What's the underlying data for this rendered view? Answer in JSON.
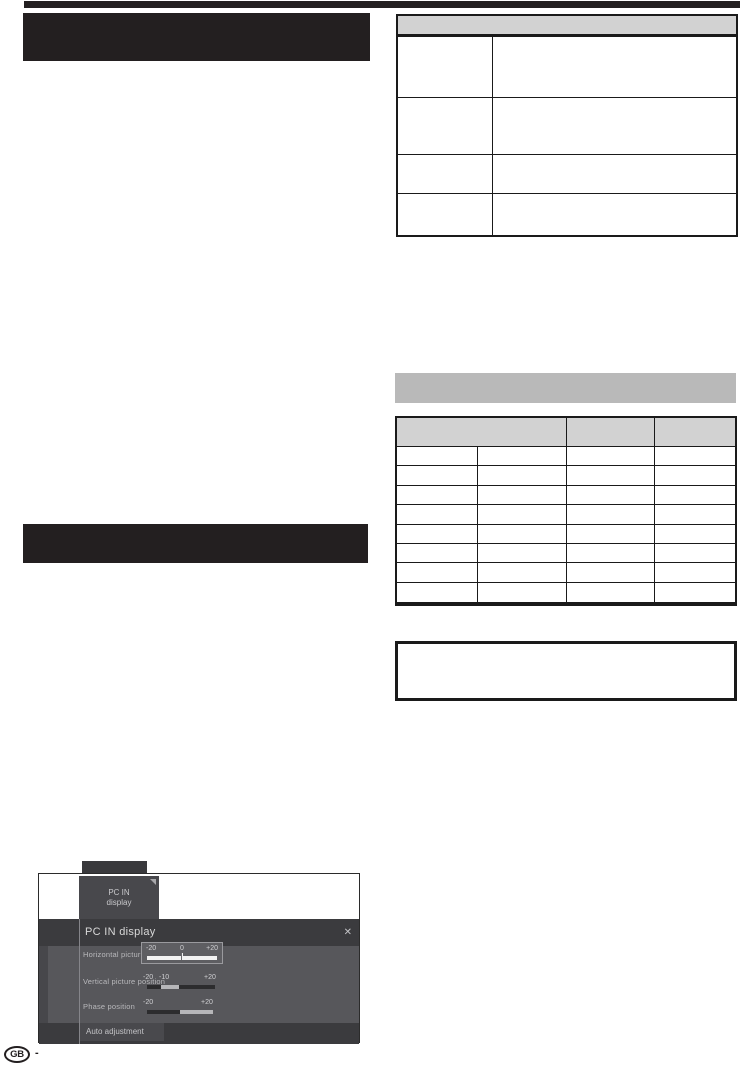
{
  "colors": {
    "print_black": "#231f20",
    "table_header_gray": "#d2d2d2",
    "section_bar_gray": "#b9b9b9",
    "osd_panel_gray": "#57575b",
    "osd_dark_gray": "#3b3b3e"
  },
  "osd_screenshot": {
    "tab": {
      "line1": "PC IN",
      "line2": "display"
    },
    "dialog": {
      "title": "PC IN display",
      "close_icon": "✕",
      "rows": [
        {
          "label": "Horizontal picture position",
          "scale": {
            "min": "-20",
            "mid": "0",
            "max": "+20"
          }
        },
        {
          "label": "Vertical picture position",
          "scale": {
            "min": "-20",
            "current": "-10",
            "max": "+20"
          }
        },
        {
          "label": "Phase position",
          "scale": {
            "min": "-20",
            "max": "+20"
          }
        }
      ],
      "button": "Auto adjustment"
    }
  },
  "footer": {
    "region_code": "GB",
    "separator": "-"
  }
}
